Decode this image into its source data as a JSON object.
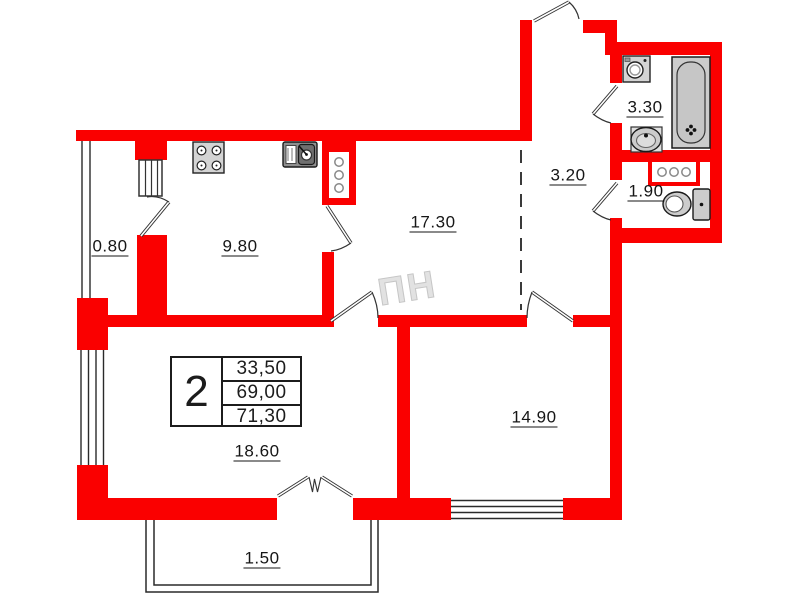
{
  "colors": {
    "wall": "#fa0000",
    "line": "#2a2a2a"
  },
  "watermark": "ПН",
  "rooms": [
    {
      "name": "balcony-left",
      "area": "0.80"
    },
    {
      "name": "kitchen",
      "area": "9.80"
    },
    {
      "name": "living-room",
      "area": "17.30"
    },
    {
      "name": "hallway",
      "area": "3.20"
    },
    {
      "name": "bathroom",
      "area": "3.30"
    },
    {
      "name": "wc",
      "area": "1.90"
    },
    {
      "name": "bedroom",
      "area": "14.90"
    },
    {
      "name": "main-room",
      "area": "18.60"
    },
    {
      "name": "balcony-bottom",
      "area": "1.50"
    }
  ],
  "summary_table": {
    "rooms_count": "2",
    "values": [
      "33,50",
      "69,00",
      "71,30"
    ]
  },
  "icons": [
    "stove-icon",
    "kitchen-sink-icon",
    "washing-machine-icon",
    "bathtub-icon",
    "washbasin-icon",
    "toilet-icon",
    "vent-shaft-icon",
    "door-arc",
    "window-lines"
  ]
}
